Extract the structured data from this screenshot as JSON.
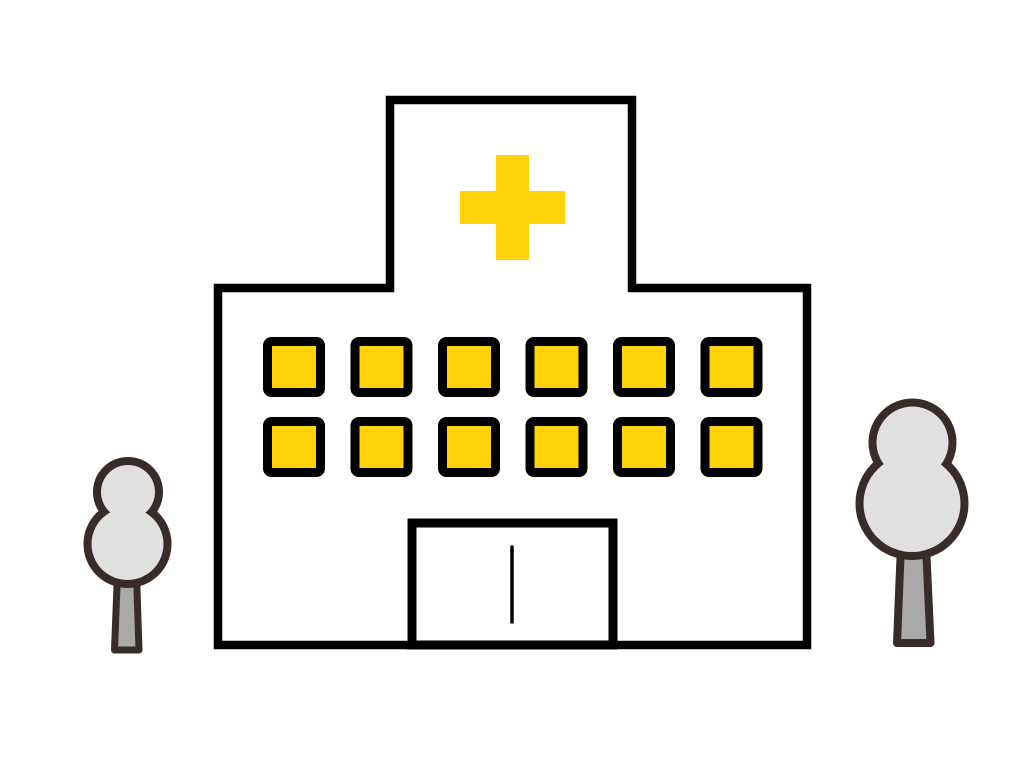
{
  "scene": {
    "description": "Flat cartoon illustration of a white hospital building with a yellow medical cross on its roof tower, two rows of yellow windows, a front entrance with a divided sliding door, flanked by a small gray tree on the left and a larger gray tree on the right, on a plain white background.",
    "building": {
      "type": "hospital",
      "cross_symbol": "medical-cross",
      "windows": {
        "rows": 2,
        "columns": 6,
        "total": 12
      },
      "entrance": "sliding-door"
    },
    "trees": {
      "count": 2,
      "positions": [
        "left",
        "right"
      ]
    }
  },
  "colors": {
    "background": "#FFFFFF",
    "building-outline": "#000000",
    "building-fill": "#FFFFFF",
    "accent-yellow": "#FFD20A",
    "tree-outline": "#382B28",
    "tree-canopy": "#E0E0E0",
    "tree-trunk": "#A9A9A9"
  }
}
